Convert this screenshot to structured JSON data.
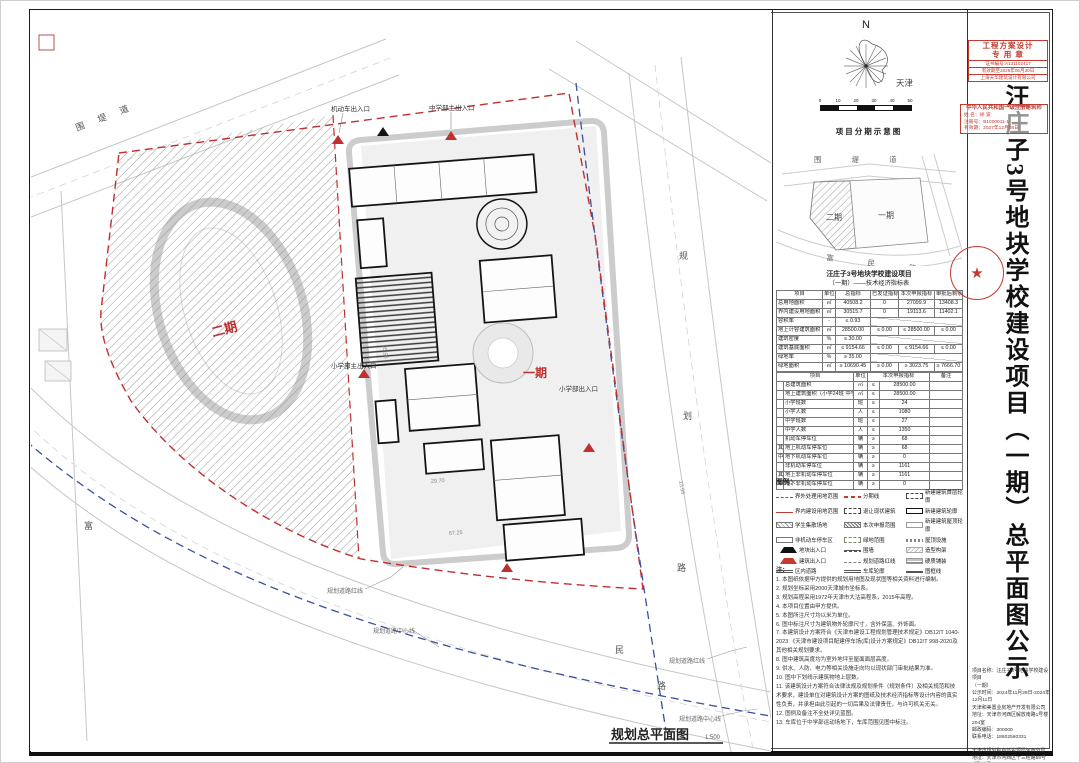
{
  "plan": {
    "caption": "规划总平面图",
    "caption_scale": "1:500",
    "phase1": "一期",
    "phase2": "二期",
    "road_nw": "围 堤 道",
    "s_chars": [
      "富",
      "民",
      "路"
    ],
    "e_chars": [
      "规",
      "划",
      "路"
    ],
    "entrance_top1": "机动车出入口",
    "entrance_top2": "中学部主出入口",
    "entrance_left": "小学部主出入口",
    "entrance_right": "小学部出入口",
    "leader_bl1": "规划道路红线",
    "leader_bl2": "规划道路中心线",
    "leader_br1": "规划道路红线",
    "leader_br2": "规划道路中心线",
    "dims": [
      "29.70",
      "67.25",
      "13.66",
      "35.50"
    ]
  },
  "panel": {
    "compass": {
      "n": "N",
      "city": "天津"
    },
    "scale_ticks": [
      "0",
      "10",
      "20",
      "30",
      "40",
      "50"
    ],
    "phasing": {
      "title": "项目分期示意图",
      "top_road": "围 堤 道",
      "bottom_road": "富 民 路",
      "phase1": "一期",
      "phase2": "二期"
    },
    "table": {
      "title": "汪庄子3号地块学校建设项目",
      "subtitle": "（一期）——技术经济指标表",
      "headers": [
        "项目",
        "单位",
        "总指标",
        "已发证指标",
        "本次申报指标",
        "审批后剩余指标"
      ],
      "rows": [
        {
          "c": [
            "总用地面积",
            "㎡",
            "40508.2",
            "0",
            "27099.9",
            "13408.3"
          ],
          "merged": false
        },
        {
          "c": [
            "界内建设用地面积",
            "㎡",
            "30515.7",
            "0",
            "19113.6",
            "11402.1"
          ],
          "merged": false
        },
        {
          "c": [
            "容积率",
            "-",
            "≤ 0.93"
          ],
          "merged": true
        },
        {
          "c": [
            "地上计容建筑面积",
            "㎡",
            "28500.00",
            "≤ 0.00",
            "≤ 28500.00",
            "≤ 0.00"
          ],
          "merged": false
        },
        {
          "c": [
            "建筑密度",
            "%",
            "≤ 30.00"
          ],
          "merged": true
        },
        {
          "c": [
            "建筑基底面积",
            "㎡",
            "≤ 9154.66",
            "≤ 0.00",
            "≤ 9154.66",
            "≤ 0.00"
          ],
          "merged": false
        },
        {
          "c": [
            "绿地率",
            "%",
            "≥ 35.00"
          ],
          "merged": true
        },
        {
          "c": [
            "绿地面积",
            "㎡",
            "≥ 10690.45",
            "≥ 0.00",
            "≥ 3023.75",
            "≥ 7666.70"
          ],
          "merged": false
        }
      ],
      "headers2": [
        "项目",
        "单位",
        "本次申报指标",
        "备注"
      ],
      "rows2": [
        [
          "",
          "总建筑面积",
          "㎡",
          "≤",
          "28500.00",
          ""
        ],
        [
          "",
          "地上建筑面积（小学24班 中学27班）",
          "㎡",
          "≤",
          "28500.00",
          ""
        ],
        [
          "",
          "小学班数",
          "班",
          "≤",
          "24",
          ""
        ],
        [
          "",
          "小学人数",
          "人",
          "≤",
          "1080",
          ""
        ],
        [
          "",
          "中学班数",
          "班",
          "≤",
          "27",
          ""
        ],
        [
          "",
          "中学人数",
          "人",
          "≤",
          "1350",
          ""
        ],
        [
          "",
          "机动车停车位",
          "辆",
          "≥",
          "68",
          ""
        ],
        [
          "其",
          "地上机动车停车位",
          "辆",
          "≥",
          "68",
          ""
        ],
        [
          "中",
          "地下机动车停车位",
          "辆",
          "≥",
          "0",
          ""
        ],
        [
          "",
          "非机动车停车位",
          "辆",
          "≥",
          "1161",
          ""
        ],
        [
          "其",
          "地上非机动车停车位",
          "辆",
          "≥",
          "1161",
          ""
        ],
        [
          "中",
          "地下非机动车停车位",
          "辆",
          "≥",
          "0",
          ""
        ]
      ]
    },
    "legend": {
      "title": "图例：",
      "columns": [
        [
          {
            "s": "s-red-dash",
            "t": "界外处理用地范围"
          },
          {
            "s": "s-red-line",
            "t": "界内建设用地范围"
          },
          {
            "s": "s-hatch",
            "t": "学生集散场地"
          },
          {
            "s": "s-box",
            "t": "非机动车停车区"
          },
          {
            "s": "s-tri-k",
            "t": "地块出入口"
          },
          {
            "s": "s-tri-r",
            "t": "建筑出入口"
          },
          {
            "s": "s-dbl",
            "t": "区内道路"
          }
        ],
        [
          {
            "s": "s-red-seg",
            "t": "分期线"
          },
          {
            "s": "s-dash-box",
            "t": "退让现状建筑"
          },
          {
            "s": "s-hatch2",
            "t": "本次申报范围"
          },
          {
            "s": "s-green-dash",
            "t": "绿地范围"
          },
          {
            "s": "s-wall",
            "t": "围墙"
          },
          {
            "s": "s-gray-dash",
            "t": "规划道路红线"
          },
          {
            "s": "s-dbl",
            "t": "车库轮廓"
          }
        ],
        [
          {
            "s": "s-dash-box",
            "t": "新建建筑首层轮廓"
          },
          {
            "s": "s-bold-box",
            "t": "新建建筑轮廓"
          },
          {
            "s": "s-thin-box",
            "t": "新建建筑屋顶轮廓"
          },
          {
            "s": "s-dots",
            "t": "屋顶设施"
          },
          {
            "s": "s-diag-lt",
            "t": "造型构架"
          },
          {
            "s": "s-hlines",
            "t": "硬质铺装"
          },
          {
            "s": "s-dbl-h",
            "t": "图框线"
          }
        ]
      ]
    },
    "notes": {
      "title": "注：",
      "items": [
        "1. 本图纸依据甲方提供的规划用地图及现状图等相关资料进行编制。",
        "2. 规划坐标采用2000天津城市坐标系。",
        "3. 规划高程采用1972年天津市大沽高程系，2015年高程。",
        "4. 本项目位置由甲方提供。",
        "5. 本图所注尺寸均以米为单位。",
        "6. 图中标注尺寸为建筑物外轮廓尺寸，含外保温、外饰面。",
        "7. 本建筑设计方案符合《天津市建设工程规划管理技术规定》DB12/T 1040-2023 《天津市建设项目配建停车场(库)设计方案规定》DB12/T 998-2020及其他相关规划要求。",
        "8. 图中建筑高度均为室外地坪至屋面面层高度。",
        "9. 供水、人防、电力等相关设施走向均以现状部门审批结果为准。",
        "10. 图中下划线示建筑物地上层数。",
        "11. 该建筑设计方案符合法律法规及规划条件（规划条件）及相关规范和技术要求，建设单位对建筑设计方案的图纸及技术经济指标等设计内容的真实性负责，并承担由此引起的一切后果及法律责任，与许可机关无关。",
        "12. 图例及备注不全处详见蓝图。",
        "13. 车库位于中学部运动场地下，车库范围见图中标注。"
      ]
    }
  },
  "title_strip": {
    "title": "汪庄子3号地块学校建设项目（一期）总平面图公示",
    "stamp_design": {
      "l1": "工程方案设计",
      "l2": "专 用 章",
      "l3": "证书编号:A131102417",
      "l4": "有效期至2029年06月30日",
      "l5": "上海天华建筑设计有限公司"
    },
    "stamp_architect": {
      "l1": "中华人民共和国一级注册建筑师",
      "l2": "姓 名：徐 波",
      "l3": "注册号：B1000011-1",
      "l4": "有效期：2027年12月08日"
    },
    "round_stamp_star": "★",
    "info_lines": [
      "项目名称：汪庄子3号地块学校建设项目",
      "（一期）",
      "公示时间：2024年11月28日-2024年12月11日",
      "天津和美置业房地产开发有限公司",
      "地址：天津市河西区解放南路1号楼204室",
      "邮政编码：300000",
      "联系电话：18602560331",
      "",
      "天津市规划和自然资源局河西分局",
      "地址：天津市河西区十三经路59号",
      "邮政编码：300202",
      "监督电话：022-24030329"
    ]
  }
}
